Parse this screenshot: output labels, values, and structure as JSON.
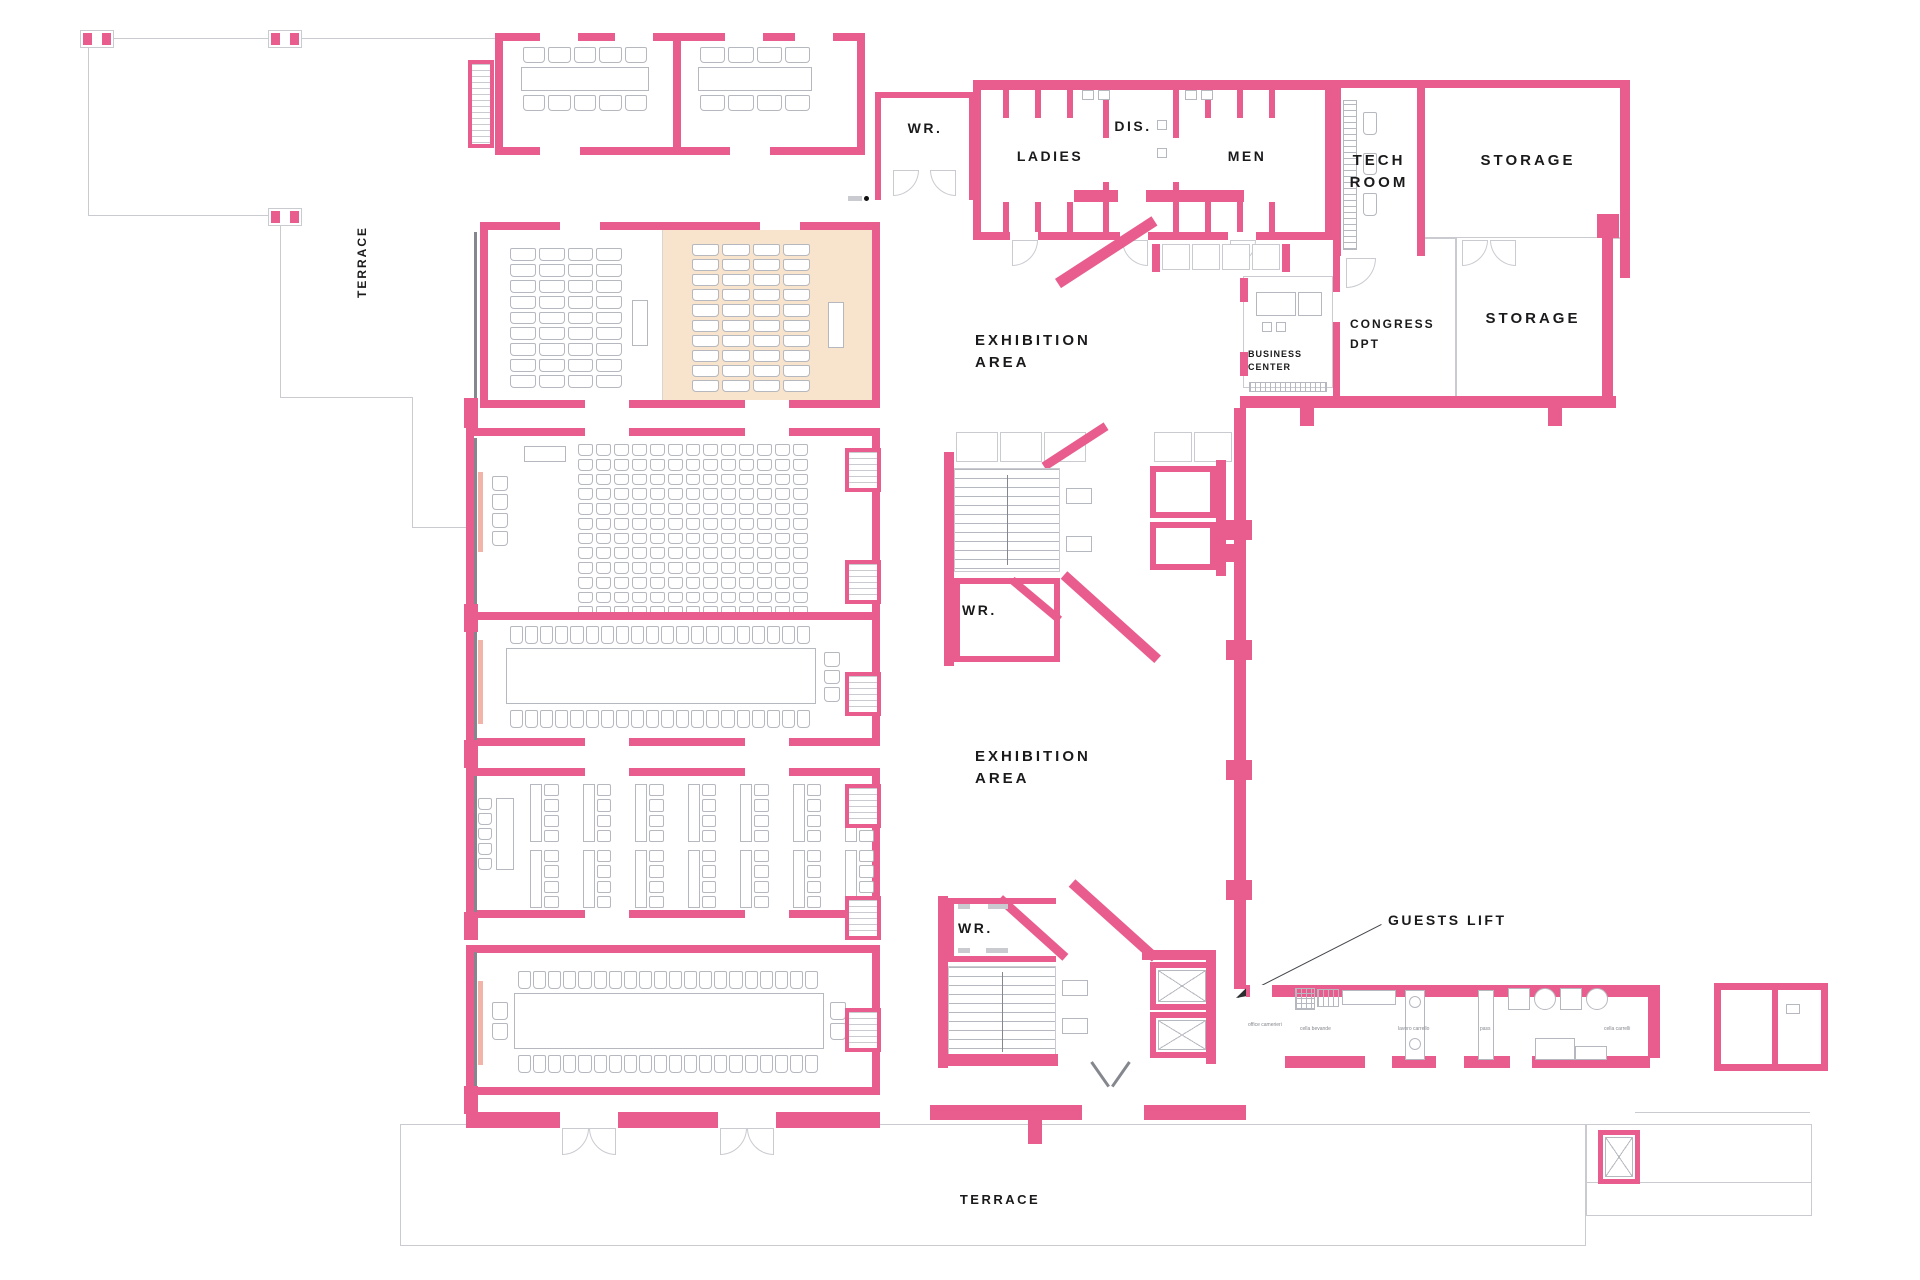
{
  "colors": {
    "wall": "#e85d8d",
    "wall_light": "#f3a8c4",
    "highlight": "#f8e3cc",
    "strip": "#f2b3a8",
    "gray": "#b6b8bf",
    "gray_dark": "#85878e",
    "line": "#c9cbd0",
    "text": "#1a1a1c"
  },
  "labels": {
    "terrace_left": "TERRACE",
    "terrace_bottom": "TERRACE",
    "wr_top": "WR.",
    "ladies": "LADIES",
    "dis": "DIS.",
    "men": "MEN",
    "tech1": "TECH",
    "tech2": "ROOM",
    "storage_top": "STORAGE",
    "storage_right": "STORAGE",
    "business1": "BUSINESS",
    "business2": "CENTER",
    "congress1": "CONGRESS",
    "congress2": "DPT",
    "exhibition1a": "EXHIBITION",
    "exhibition1b": "AREA",
    "exhibition2a": "EXHIBITION",
    "exhibition2b": "AREA",
    "wr_mid": "WR.",
    "wr_low": "WR.",
    "guests_lift": "GUESTS LIFT",
    "svc_office": "office camerieri",
    "svc_bevande": "cella bevande",
    "svc_lavoro": "lavoro carrello",
    "svc_pass": "pass",
    "svc_carrelli": "cella carrelli"
  }
}
